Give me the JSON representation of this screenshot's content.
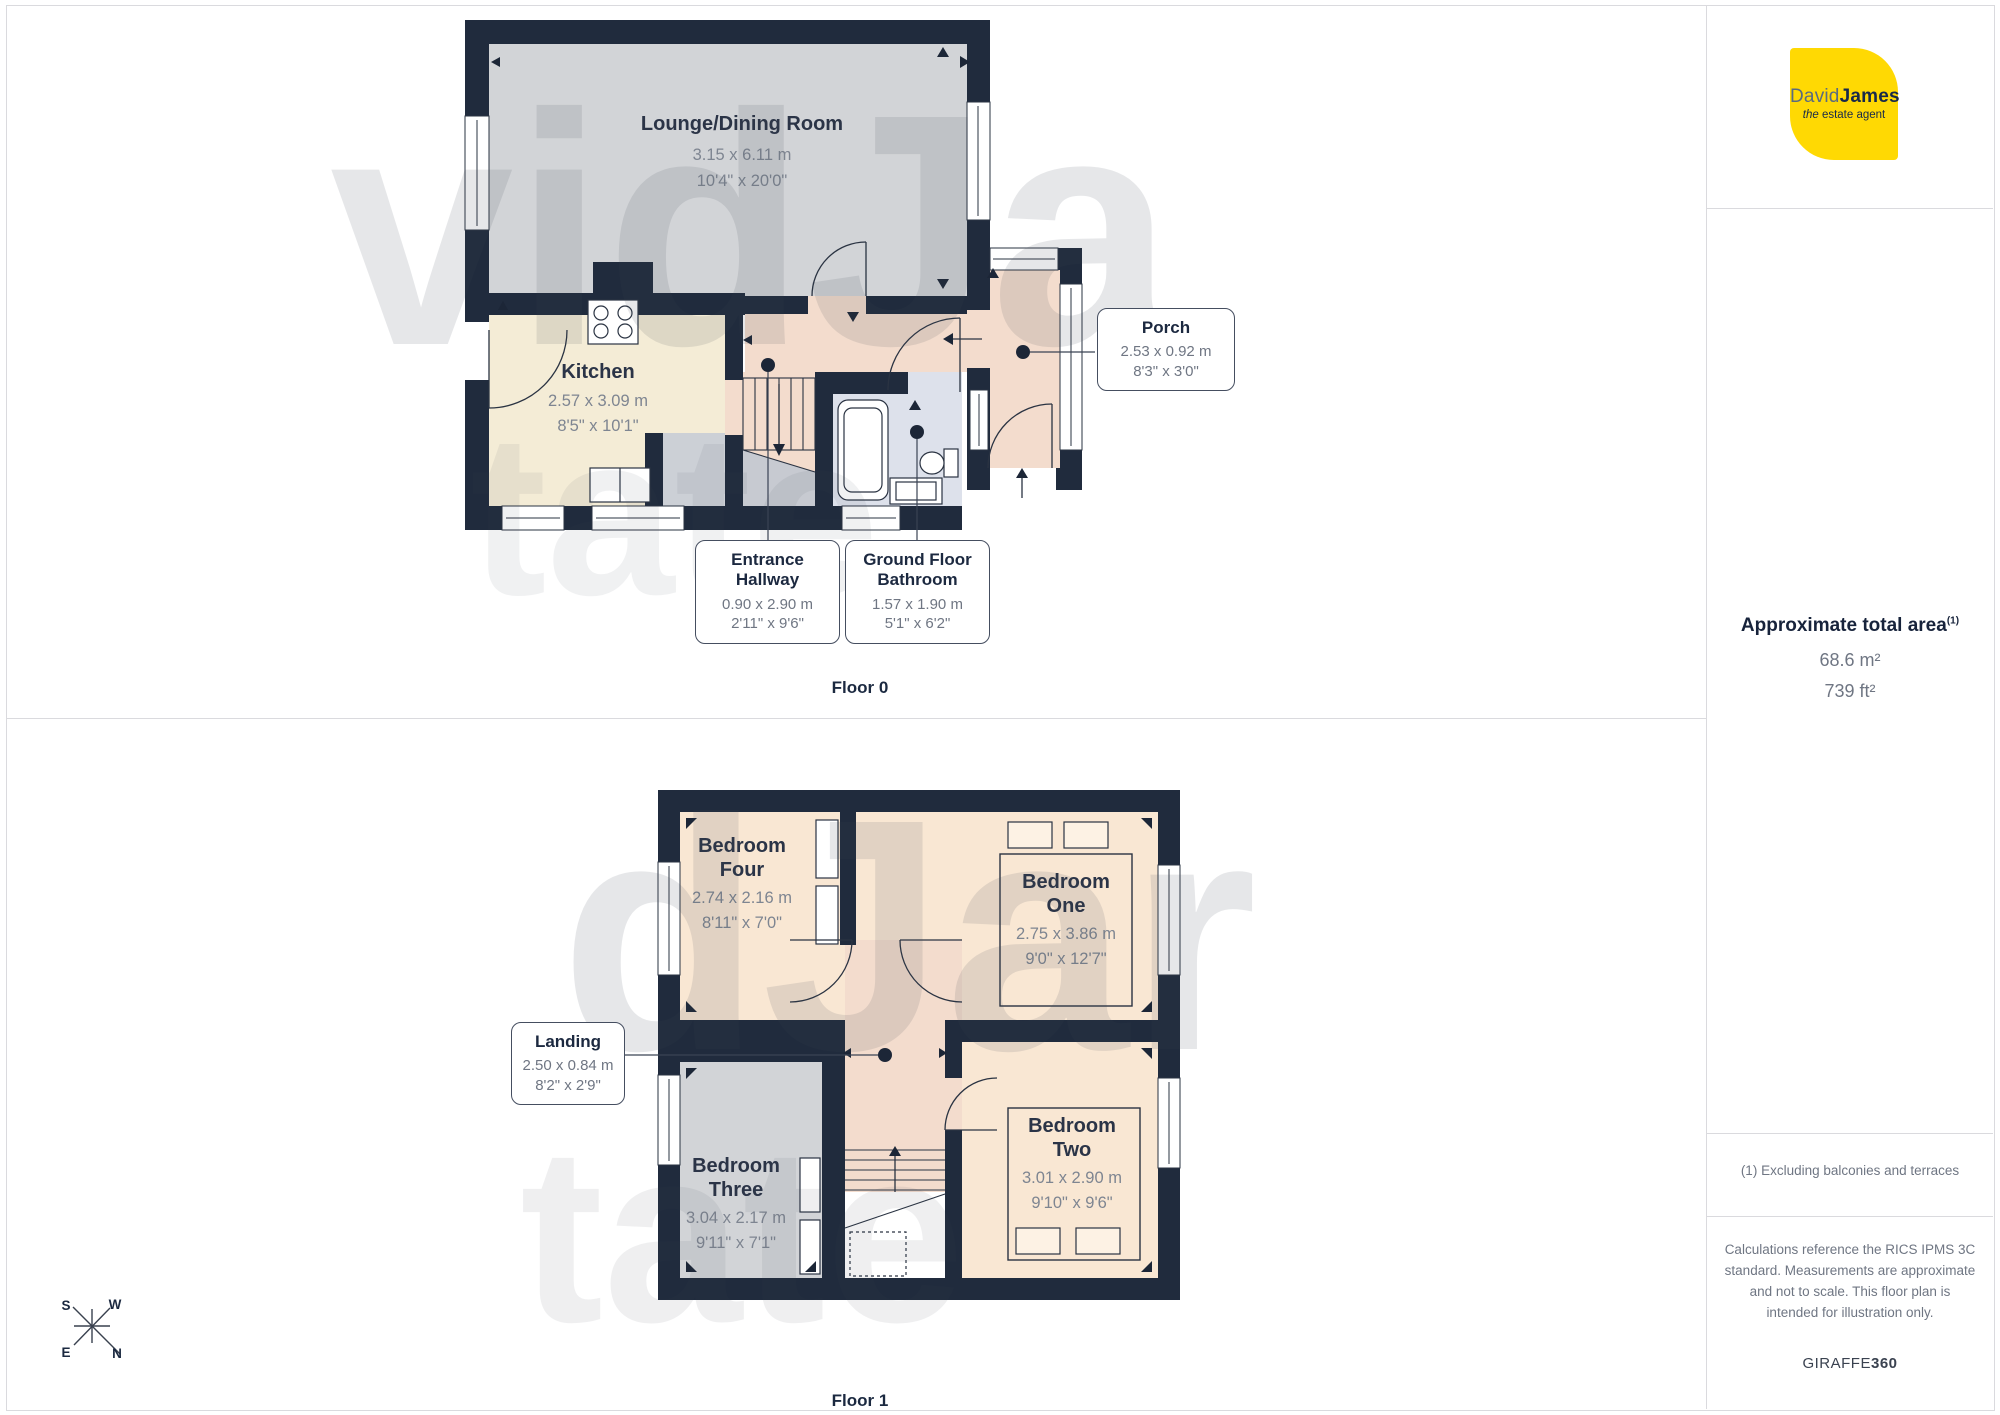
{
  "floors": {
    "floor0": {
      "label": "Floor 0",
      "rooms": {
        "lounge": {
          "name": "Lounge/Dining Room",
          "metric": "3.15 x 6.11 m",
          "imperial": "10'4\" x 20'0\""
        },
        "kitchen": {
          "name": "Kitchen",
          "metric": "2.57 x 3.09 m",
          "imperial": "8'5\" x 10'1\""
        }
      },
      "callouts": {
        "porch": {
          "name": "Porch",
          "metric": "2.53 x 0.92 m",
          "imperial": "8'3\" x 3'0\""
        },
        "entrance": {
          "name1": "Entrance",
          "name2": "Hallway",
          "metric": "0.90 x 2.90 m",
          "imperial": "2'11\" x 9'6\""
        },
        "bathroom": {
          "name1": "Ground Floor",
          "name2": "Bathroom",
          "metric": "1.57 x 1.90 m",
          "imperial": "5'1\" x 6'2\""
        }
      }
    },
    "floor1": {
      "label": "Floor 1",
      "rooms": {
        "bedroom_four": {
          "name1": "Bedroom",
          "name2": "Four",
          "metric": "2.74 x 2.16 m",
          "imperial": "8'11\" x 7'0\""
        },
        "bedroom_one": {
          "name1": "Bedroom",
          "name2": "One",
          "metric": "2.75 x 3.86 m",
          "imperial": "9'0\" x 12'7\""
        },
        "bedroom_two": {
          "name1": "Bedroom",
          "name2": "Two",
          "metric": "3.01 x 2.90 m",
          "imperial": "9'10\" x 9'6\""
        },
        "bedroom_three": {
          "name1": "Bedroom",
          "name2": "Three",
          "metric": "3.04 x 2.17 m",
          "imperial": "9'11\" x 7'1\""
        }
      },
      "callouts": {
        "landing": {
          "name": "Landing",
          "metric": "2.50 x 0.84 m",
          "imperial": "8'2\" x 2'9\""
        }
      }
    }
  },
  "sidebar": {
    "logo": {
      "brand1": "David",
      "brand2": "James",
      "tagline_a": "the",
      "tagline_b": " estate agent"
    },
    "area": {
      "title": "Approximate total area",
      "sup": "(1)",
      "metric": "68.6 m²",
      "imperial": "739 ft²"
    },
    "notes": {
      "exclusion": "(1) Excluding balconies and terraces",
      "disclaimer": "Calculations reference the RICS IPMS 3C standard. Measurements are approximate and not to scale. This floor plan is intended for illustration only.",
      "brand_a": "GIRAFFE",
      "brand_b": "360"
    }
  },
  "compass": {
    "n": "N",
    "e": "E",
    "s": "S",
    "w": "W"
  },
  "watermark": {
    "piece1": "vidJa",
    "piece2": "tate",
    "piece3": "dJar",
    "piece4": "tate"
  },
  "colors": {
    "wall": "#202b3d",
    "lounge": "#d2d4d7",
    "kitchen": "#f4ecd6",
    "hall": "#f3dccd",
    "bath": "#dde1eb",
    "bedroom": "#f9e7d3",
    "accent_yellow": "#ffd903"
  }
}
